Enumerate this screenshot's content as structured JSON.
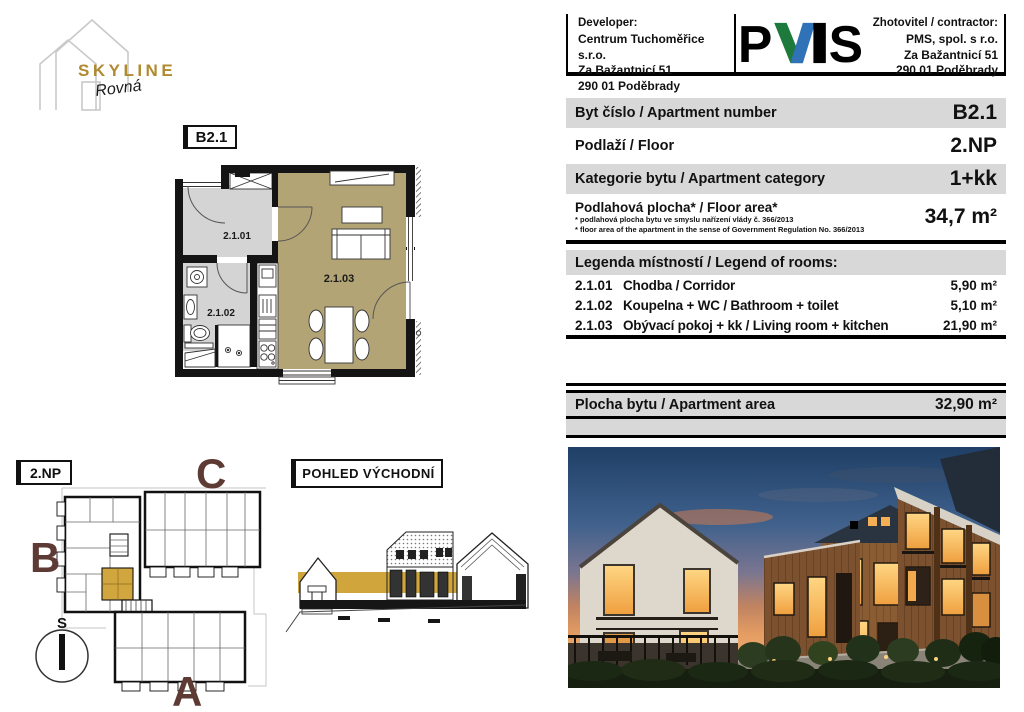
{
  "brand": {
    "name": "SKYLINE",
    "script": "Rovná"
  },
  "header": {
    "developer_label": "Developer:",
    "developer_name": "Centrum Tuchoměřice s.r.o.",
    "developer_addr1": "Za Bažantnicí 51",
    "developer_addr2": "290 01 Poděbrady",
    "pms_p": "P",
    "pms_s": "S",
    "contractor_label": "Zhotovitel / contractor:",
    "contractor_name": "PMS, spol. s r.o.",
    "contractor_addr1": "Za Bažantnicí 51",
    "contractor_addr2": "290 01 Poděbrady"
  },
  "table": {
    "rows": [
      {
        "label": "Byt číslo / Apartment number",
        "value": "B2.1"
      },
      {
        "label": "Podlaží / Floor",
        "value": "2.NP"
      },
      {
        "label": "Kategorie bytu / Apartment category",
        "value": "1+kk"
      },
      {
        "label": "Podlahová plocha* / Floor area*",
        "value": "34,7 m²",
        "note1": "* podlahová plocha bytu ve smyslu nařízení vlády č. 366/2013",
        "note2": "* floor area of the apartment in the sense of Government Regulation No. 366/2013"
      }
    ]
  },
  "legend": {
    "title": "Legenda místností / Legend of rooms:",
    "rows": [
      {
        "code": "2.1.01",
        "name": "Chodba / Corridor",
        "area": "5,90 m²"
      },
      {
        "code": "2.1.02",
        "name": "Koupelna + WC / Bathroom + toilet",
        "area": "5,10 m²"
      },
      {
        "code": "2.1.03",
        "name": "Obývací pokoj + kk / Living room + kitchen",
        "area": "21,90 m²"
      }
    ]
  },
  "summary": {
    "label": "Plocha bytu / Apartment area",
    "value": "32,90 m²"
  },
  "floorplan": {
    "unit": "B2.1",
    "room1": "2.1.01",
    "room2": "2.1.02",
    "room3": "2.1.03"
  },
  "siteplan": {
    "floor": "2.NP",
    "building_a": "A",
    "building_b": "B",
    "building_c": "C",
    "compass": "S"
  },
  "elevation": {
    "title": "POHLED VÝCHODNÍ"
  },
  "colors": {
    "gold": "#cfa53c",
    "floor_tan": "#b3a476",
    "floor_gray": "#d4d4d4",
    "building_letter": "#5d3a33",
    "pms_green": "#1e7a3c",
    "pms_blue": "#2f72b8",
    "row_gray": "#d8d8d8"
  }
}
